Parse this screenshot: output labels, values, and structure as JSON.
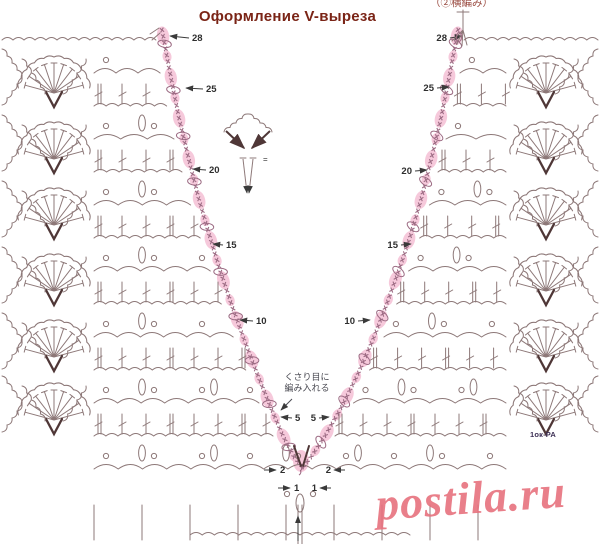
{
  "title": "Оформление V-выреза",
  "watermark": "postila.ru",
  "notes": {
    "top_right": "（②横編み）",
    "neck_line1": "くさり目に",
    "neck_line2": "編み入れる",
    "size_label": "1ок-РА",
    "equals_sign": "="
  },
  "colors": {
    "title": "#7a2416",
    "label": "#2e2e2e",
    "line": "#8d7878",
    "bold": "#4f3737",
    "pink": "#f5c2d6",
    "pink_deep": "#eeaac6",
    "edge_x": "#9c6b83",
    "watermark": "#e7727e",
    "note": "#4a4a52",
    "arrow": "#3a3a3a"
  },
  "diagram": {
    "edge_left": [
      [
        162,
        30
      ],
      [
        171,
        78
      ],
      [
        179,
        118
      ],
      [
        188,
        156
      ],
      [
        198,
        196
      ],
      [
        209,
        234
      ],
      [
        220,
        270
      ],
      [
        232,
        306
      ],
      [
        245,
        342
      ],
      [
        258,
        376
      ],
      [
        271,
        408
      ],
      [
        283,
        436
      ],
      [
        294,
        457
      ],
      [
        302,
        467
      ]
    ],
    "edge_right": [
      [
        458,
        30
      ],
      [
        449,
        78
      ],
      [
        441,
        118
      ],
      [
        432,
        156
      ],
      [
        422,
        196
      ],
      [
        411,
        234
      ],
      [
        399,
        270
      ],
      [
        386,
        306
      ],
      [
        372,
        342
      ],
      [
        357,
        376
      ],
      [
        341,
        408
      ],
      [
        325,
        436
      ],
      [
        311,
        457
      ],
      [
        303,
        467
      ]
    ],
    "rows": {
      "y0": 40,
      "step": 33,
      "count": 14
    },
    "panel_left": {
      "x_start": 94
    },
    "panel_right": {
      "x_end": 506
    },
    "fans_left": {
      "cx": 54,
      "tiers": [
        107,
        173,
        239,
        305,
        371,
        434
      ]
    },
    "fans_right": {
      "cx": 546,
      "tiers": [
        107,
        173,
        239,
        305,
        371,
        434
      ]
    },
    "labels_left": [
      {
        "v": "28",
        "tx": 192,
        "ty": 41,
        "anchor": "start",
        "lx": 189,
        "ly": 38,
        "hx": 170,
        "hy": 36
      },
      {
        "v": "25",
        "tx": 206,
        "ty": 92,
        "anchor": "start",
        "lx": 203,
        "ly": 89,
        "hx": 186,
        "hy": 88
      },
      {
        "v": "20",
        "tx": 209,
        "ty": 173,
        "anchor": "start",
        "lx": 206,
        "ly": 170,
        "hx": 193,
        "hy": 169
      },
      {
        "v": "15",
        "tx": 226,
        "ty": 248,
        "anchor": "start",
        "lx": 223,
        "ly": 245,
        "hx": 213,
        "hy": 244
      },
      {
        "v": "10",
        "tx": 256,
        "ty": 324,
        "anchor": "start",
        "lx": 253,
        "ly": 321,
        "hx": 240,
        "hy": 320
      },
      {
        "v": "5",
        "tx": 295,
        "ty": 421,
        "anchor": "start",
        "lx": 292,
        "ly": 418,
        "hx": 281,
        "hy": 417
      },
      {
        "v": "2",
        "tx": 280,
        "ty": 473,
        "anchor": "start",
        "lx": 264,
        "ly": 470,
        "hx": 276,
        "hy": 470
      },
      {
        "v": "1",
        "tx": 294,
        "ty": 491,
        "anchor": "start",
        "lx": 278,
        "ly": 488,
        "hx": 290,
        "hy": 488
      }
    ],
    "labels_right": [
      {
        "v": "28",
        "tx": 447,
        "ty": 41,
        "anchor": "end",
        "lx": 450,
        "ly": 38,
        "hx": 462,
        "hy": 36
      },
      {
        "v": "25",
        "tx": 434,
        "ty": 91,
        "anchor": "end",
        "lx": 437,
        "ly": 88,
        "hx": 449,
        "hy": 87
      },
      {
        "v": "20",
        "tx": 412,
        "ty": 174,
        "anchor": "end",
        "lx": 415,
        "ly": 171,
        "hx": 427,
        "hy": 170
      },
      {
        "v": "15",
        "tx": 398,
        "ty": 248,
        "anchor": "end",
        "lx": 401,
        "ly": 245,
        "hx": 411,
        "hy": 244
      },
      {
        "v": "10",
        "tx": 355,
        "ty": 324,
        "anchor": "end",
        "lx": 358,
        "ly": 321,
        "hx": 370,
        "hy": 320
      },
      {
        "v": "5",
        "tx": 316,
        "ty": 421,
        "anchor": "end",
        "lx": 319,
        "ly": 418,
        "hx": 329,
        "hy": 417
      },
      {
        "v": "1",
        "tx": 317,
        "ty": 491,
        "anchor": "end",
        "lx": 331,
        "ly": 488,
        "hx": 320,
        "hy": 488
      },
      {
        "v": "2",
        "tx": 331,
        "ty": 473,
        "anchor": "end",
        "lx": 345,
        "ly": 470,
        "hx": 334,
        "hy": 470
      }
    ],
    "inset": {
      "cx": 248,
      "cy": 150
    },
    "apex": {
      "x": 302,
      "y": 466
    },
    "bottom_arrow": {
      "x": 298,
      "y1": 541,
      "y2": 516
    },
    "note_arrow": {
      "x1": 292,
      "y1": 399,
      "x2": 281,
      "y2": 410
    }
  }
}
